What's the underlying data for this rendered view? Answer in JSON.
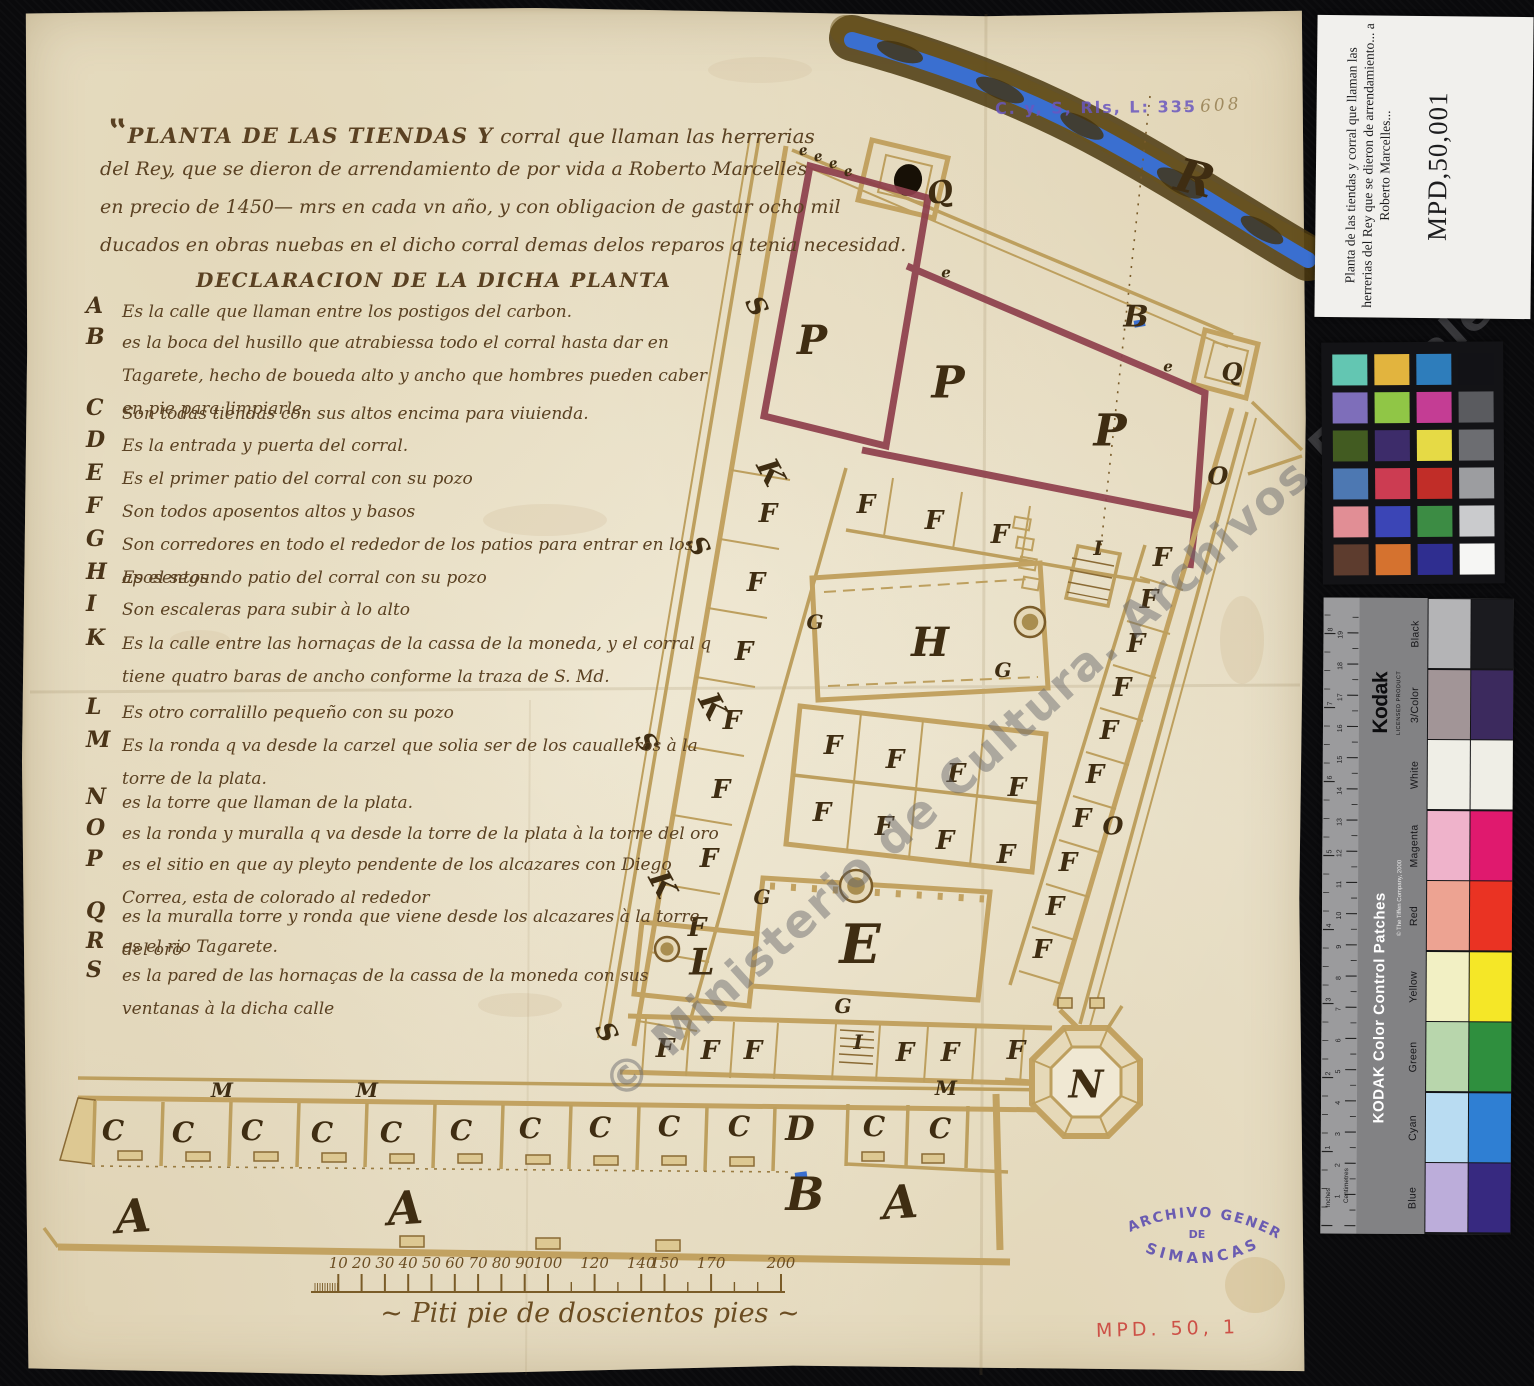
{
  "colors": {
    "paper": "#eae2cc",
    "ink": "#5a4122",
    "ink_dark": "#3f2d12",
    "wall_tan": "#c2a261",
    "boundary_maroon": "#8e3f4c",
    "river_blue": "#3a6fd0",
    "river_bank": "#4c3a10",
    "stamp_purple": "#6a57c0",
    "accession_red": "#cd5147",
    "background_black": "#0a0a0c",
    "watermark_gray": "#68686c"
  },
  "archive_ref": {
    "stamp": "C. y, S, Rls, L: 335",
    "pencil": "- 608"
  },
  "title": {
    "line1_caps": "PLANTA DE LAS TIENDAS Y",
    "line1_rest": " corral que llaman las herrerias",
    "line2": "del Rey, que se dieron de arrendamiento de por vida a Roberto Marcelles",
    "line3": "en precio de 1450— mrs en cada vn año, y con obligacion de gastar ocho mil",
    "line4": "ducados en obras nuebas en el dicho corral demas delos reparos q tenia necesidad.",
    "declaration": "DECLARACION DE LA DICHA PLANTA"
  },
  "legend": [
    {
      "key": "A",
      "text": "Es la calle que llaman entre los postigos del carbon."
    },
    {
      "key": "B",
      "text": "es la boca del husillo que atrabiessa todo el corral hasta dar en Tagarete, hecho de boueda alto y ancho que hombres pueden caber en pie para limpiarle."
    },
    {
      "key": "C",
      "text": "Son todas tiendas con sus altos encima para viuienda."
    },
    {
      "key": "D",
      "text": "Es la entrada y puerta del corral."
    },
    {
      "key": "E",
      "text": "Es el primer patio del corral con su pozo"
    },
    {
      "key": "F",
      "text": "Son todos aposentos altos y basos"
    },
    {
      "key": "G",
      "text": "Son corredores en todo el rededor de los patios para entrar en los aposentos"
    },
    {
      "key": "H",
      "text": "Es el segundo patio del corral con su pozo"
    },
    {
      "key": "I",
      "text": "Son escaleras para subir à lo alto"
    },
    {
      "key": "K",
      "text": "Es la calle entre las hornaças de la cassa de la moneda, y el corral q tiene quatro baras de ancho conforme la traza de S. Md."
    },
    {
      "key": "L",
      "text": "Es otro corralillo pequeño con su pozo"
    },
    {
      "key": "M",
      "text": "Es la ronda q va desde la carzel que solia ser de los caualleros à la torre de la plata."
    },
    {
      "key": "N",
      "text": "es la torre que llaman de la plata."
    },
    {
      "key": "O",
      "text": "es la ronda y muralla q va desde la torre de la plata à la torre del oro"
    },
    {
      "key": "P",
      "text": "es el sitio en que ay pleyto pendente de los alcazares con Diego Correa, esta de colorado al rededor"
    },
    {
      "key": "Q",
      "text": "es la muralla torre y ronda que viene desde los alcazares à la torre del oro"
    },
    {
      "key": "R",
      "text": "es el rio Tagarete."
    },
    {
      "key": "S",
      "text": "es la pared de las hornaças de la cassa de la moneda con sus ventanas à la dicha calle"
    }
  ],
  "plan": {
    "letters": [
      {
        "t": "R",
        "x": 1195,
        "y": 178,
        "s": 46,
        "r": 14
      },
      {
        "t": "B",
        "x": 1136,
        "y": 316,
        "s": 30
      },
      {
        "t": "Q",
        "x": 940,
        "y": 192,
        "s": 30,
        "r": -12
      },
      {
        "t": "Q",
        "x": 1232,
        "y": 372,
        "s": 24
      },
      {
        "t": "e",
        "x": 803,
        "y": 150,
        "s": 14,
        "r": -10
      },
      {
        "t": "e",
        "x": 818,
        "y": 156,
        "s": 14,
        "r": -10
      },
      {
        "t": "e",
        "x": 833,
        "y": 163,
        "s": 14,
        "r": -10
      },
      {
        "t": "e",
        "x": 848,
        "y": 171,
        "s": 14,
        "r": -10
      },
      {
        "t": "e",
        "x": 946,
        "y": 272,
        "s": 15
      },
      {
        "t": "e",
        "x": 1168,
        "y": 366,
        "s": 15
      },
      {
        "t": "P",
        "x": 812,
        "y": 340,
        "s": 40
      },
      {
        "t": "P",
        "x": 948,
        "y": 382,
        "s": 44
      },
      {
        "t": "P",
        "x": 1110,
        "y": 430,
        "s": 44
      },
      {
        "t": "O",
        "x": 1218,
        "y": 476,
        "s": 24
      },
      {
        "t": "O",
        "x": 1113,
        "y": 826,
        "s": 24
      },
      {
        "t": "S",
        "x": 757,
        "y": 306,
        "s": 26,
        "r": 62
      },
      {
        "t": "S",
        "x": 699,
        "y": 546,
        "s": 26,
        "r": 62
      },
      {
        "t": "S",
        "x": 647,
        "y": 742,
        "s": 26,
        "r": 62
      },
      {
        "t": "S",
        "x": 607,
        "y": 1032,
        "s": 26,
        "r": 62
      },
      {
        "t": "K",
        "x": 771,
        "y": 472,
        "s": 30,
        "r": 62
      },
      {
        "t": "K",
        "x": 713,
        "y": 706,
        "s": 30,
        "r": 62
      },
      {
        "t": "K",
        "x": 663,
        "y": 884,
        "s": 30,
        "r": 62
      },
      {
        "t": "F",
        "x": 866,
        "y": 504,
        "s": 26
      },
      {
        "t": "F",
        "x": 934,
        "y": 520,
        "s": 26
      },
      {
        "t": "F",
        "x": 1000,
        "y": 534,
        "s": 26
      },
      {
        "t": "F",
        "x": 768,
        "y": 513,
        "s": 26
      },
      {
        "t": "F",
        "x": 756,
        "y": 582,
        "s": 26
      },
      {
        "t": "F",
        "x": 744,
        "y": 651,
        "s": 26
      },
      {
        "t": "F",
        "x": 732,
        "y": 720,
        "s": 26
      },
      {
        "t": "F",
        "x": 721,
        "y": 789,
        "s": 26
      },
      {
        "t": "F",
        "x": 709,
        "y": 858,
        "s": 26
      },
      {
        "t": "F",
        "x": 697,
        "y": 927,
        "s": 26
      },
      {
        "t": "F",
        "x": 833,
        "y": 745,
        "s": 26
      },
      {
        "t": "F",
        "x": 895,
        "y": 759,
        "s": 26
      },
      {
        "t": "F",
        "x": 956,
        "y": 773,
        "s": 26
      },
      {
        "t": "F",
        "x": 1017,
        "y": 787,
        "s": 26
      },
      {
        "t": "F",
        "x": 822,
        "y": 812,
        "s": 26
      },
      {
        "t": "F",
        "x": 884,
        "y": 826,
        "s": 26
      },
      {
        "t": "F",
        "x": 945,
        "y": 840,
        "s": 26
      },
      {
        "t": "F",
        "x": 1006,
        "y": 854,
        "s": 26
      },
      {
        "t": "F",
        "x": 1162,
        "y": 557,
        "s": 26
      },
      {
        "t": "F",
        "x": 1149,
        "y": 599,
        "s": 26
      },
      {
        "t": "F",
        "x": 1136,
        "y": 643,
        "s": 26
      },
      {
        "t": "F",
        "x": 1122,
        "y": 687,
        "s": 26
      },
      {
        "t": "F",
        "x": 1109,
        "y": 730,
        "s": 26
      },
      {
        "t": "F",
        "x": 1095,
        "y": 774,
        "s": 26
      },
      {
        "t": "F",
        "x": 1082,
        "y": 818,
        "s": 26
      },
      {
        "t": "F",
        "x": 1068,
        "y": 862,
        "s": 26
      },
      {
        "t": "F",
        "x": 1055,
        "y": 906,
        "s": 26
      },
      {
        "t": "F",
        "x": 1042,
        "y": 949,
        "s": 26
      },
      {
        "t": "F",
        "x": 665,
        "y": 1048,
        "s": 26
      },
      {
        "t": "F",
        "x": 710,
        "y": 1050,
        "s": 26
      },
      {
        "t": "F",
        "x": 753,
        "y": 1050,
        "s": 26
      },
      {
        "t": "F",
        "x": 905,
        "y": 1052,
        "s": 26
      },
      {
        "t": "F",
        "x": 950,
        "y": 1052,
        "s": 26
      },
      {
        "t": "F",
        "x": 1016,
        "y": 1050,
        "s": 26
      },
      {
        "t": "G",
        "x": 815,
        "y": 622,
        "s": 20
      },
      {
        "t": "G",
        "x": 1003,
        "y": 670,
        "s": 20
      },
      {
        "t": "G",
        "x": 762,
        "y": 897,
        "s": 20
      },
      {
        "t": "G",
        "x": 843,
        "y": 1006,
        "s": 20
      },
      {
        "t": "H",
        "x": 930,
        "y": 642,
        "s": 40
      },
      {
        "t": "E",
        "x": 860,
        "y": 944,
        "s": 54
      },
      {
        "t": "L",
        "x": 702,
        "y": 962,
        "s": 36
      },
      {
        "t": "N",
        "x": 1086,
        "y": 1084,
        "s": 38
      },
      {
        "t": "I",
        "x": 1098,
        "y": 548,
        "s": 20
      },
      {
        "t": "I",
        "x": 858,
        "y": 1042,
        "s": 20
      },
      {
        "t": "M",
        "x": 222,
        "y": 1090,
        "s": 20
      },
      {
        "t": "M",
        "x": 367,
        "y": 1090,
        "s": 20
      },
      {
        "t": "M",
        "x": 946,
        "y": 1088,
        "s": 20
      },
      {
        "t": "D",
        "x": 800,
        "y": 1128,
        "s": 34
      },
      {
        "t": "C",
        "x": 113,
        "y": 1130,
        "s": 28
      },
      {
        "t": "C",
        "x": 183,
        "y": 1132,
        "s": 28
      },
      {
        "t": "C",
        "x": 252,
        "y": 1130,
        "s": 28
      },
      {
        "t": "C",
        "x": 322,
        "y": 1132,
        "s": 28
      },
      {
        "t": "C",
        "x": 391,
        "y": 1132,
        "s": 28
      },
      {
        "t": "C",
        "x": 461,
        "y": 1130,
        "s": 28
      },
      {
        "t": "C",
        "x": 530,
        "y": 1128,
        "s": 28
      },
      {
        "t": "C",
        "x": 600,
        "y": 1127,
        "s": 28
      },
      {
        "t": "C",
        "x": 669,
        "y": 1126,
        "s": 28
      },
      {
        "t": "C",
        "x": 739,
        "y": 1126,
        "s": 28
      },
      {
        "t": "C",
        "x": 874,
        "y": 1126,
        "s": 28
      },
      {
        "t": "C",
        "x": 940,
        "y": 1128,
        "s": 28
      },
      {
        "t": "A",
        "x": 133,
        "y": 1216,
        "s": 46,
        "r": -4
      },
      {
        "t": "A",
        "x": 405,
        "y": 1208,
        "s": 46,
        "r": -4
      },
      {
        "t": "A",
        "x": 900,
        "y": 1202,
        "s": 46,
        "r": -4
      },
      {
        "t": "B",
        "x": 805,
        "y": 1194,
        "s": 46
      }
    ],
    "wells": [
      {
        "x": 1030,
        "y": 622,
        "r": 15
      },
      {
        "x": 856,
        "y": 886,
        "r": 16
      },
      {
        "x": 667,
        "y": 949,
        "r": 12
      }
    ],
    "scale_bar": {
      "x0": 315,
      "px_per_unit": 2.33,
      "y": 1292,
      "labeled_ticks": [
        10,
        20,
        30,
        40,
        50,
        60,
        70,
        80,
        90,
        100,
        120,
        140,
        150,
        170,
        200
      ],
      "minor_ticks": [
        110,
        130,
        160,
        180,
        190
      ],
      "caption": "~ Piti pie de doscientos pies ~"
    }
  },
  "watermark": "© Ministerio de Cultura. Archivos Estatales",
  "stamps": {
    "simancas_top": "ARCHIVO GENERAL",
    "simancas_mid": "DE",
    "simancas_bottom": "SIMANCAS",
    "accession": "MPD. 50, 1"
  },
  "side_panel": {
    "label_card": {
      "title_lines": [
        "Planta de las tiendas y corral que llaman las",
        "herrerias del Rey que se dieron de arrendamiento... a",
        "Roberto Marcelles..."
      ],
      "id": "MPD,50,001"
    },
    "color_checker": {
      "rows": [
        [
          "#63c6b2",
          "#e2b43e",
          "#2e7dbb",
          "#121216"
        ],
        [
          "#7e6eba",
          "#90c646",
          "#c43d94",
          "#5a5b5f"
        ],
        [
          "#425b21",
          "#3d2c6a",
          "#e6da45",
          "#6c6d71"
        ],
        [
          "#4d78b2",
          "#cc3c52",
          "#c12d28",
          "#9c9da0"
        ],
        [
          "#e18e95",
          "#3b45b6",
          "#3c8c44",
          "#cacbcd"
        ],
        [
          "#5d3c2e",
          "#d5722f",
          "#2f2e90",
          "#f6f6f4"
        ]
      ]
    },
    "kodak": {
      "brand": "Kodak",
      "licensed": "LICENSED PRODUCT",
      "title": "KODAK Color Control Patches",
      "copyright": "© The Tiffen Company, 2000",
      "ruler": {
        "left_label": "Inches",
        "right_label": "Centimetres",
        "inches_max": 8,
        "cm_max": 19
      },
      "patches": [
        {
          "name": "Black",
          "light": "#b4b4b6",
          "full": "#1b1b1f"
        },
        {
          "name": "3/Color",
          "light": "#a29597",
          "full": "#3c2a5e"
        },
        {
          "name": "White",
          "light": "#efeee6",
          "full": "#efeee6"
        },
        {
          "name": "Magenta",
          "light": "#efb3cb",
          "full": "#e0196e"
        },
        {
          "name": "Red",
          "light": "#eda392",
          "full": "#ea3323"
        },
        {
          "name": "Yellow",
          "light": "#f2f0c4",
          "full": "#f5e727"
        },
        {
          "name": "Green",
          "light": "#b8d6ac",
          "full": "#2f8f3e"
        },
        {
          "name": "Cyan",
          "light": "#b9dcf2",
          "full": "#2f7fd3"
        },
        {
          "name": "Blue",
          "light": "#bcadda",
          "full": "#372980"
        }
      ]
    }
  }
}
